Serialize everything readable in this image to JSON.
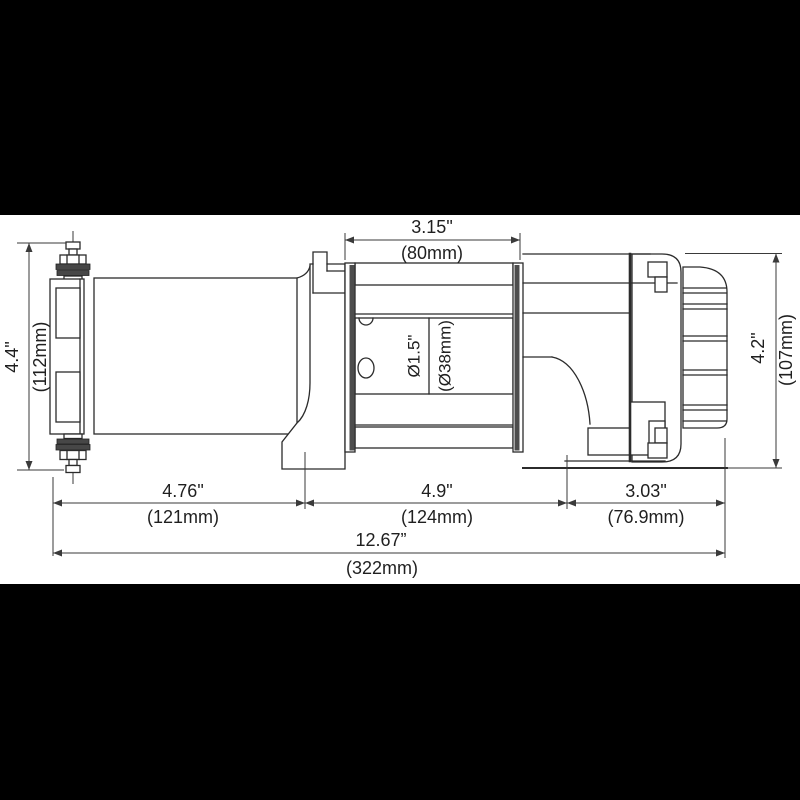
{
  "drawing": {
    "subject": "electric-winch-side-view-dimension-drawing",
    "colors": {
      "background": "#000000",
      "canvas": "#ffffff",
      "line": "#2b2b2b"
    },
    "dimensions": {
      "drum_width_in": "3.15\"",
      "drum_width_mm": "(80mm)",
      "left_height_in": "4.4\"",
      "left_height_mm": "(112mm)",
      "right_height_in": "4.2\"",
      "right_height_mm": "(107mm)",
      "rope_diameter_in": "Ø1.5\"",
      "rope_diameter_mm": "(Ø38mm)",
      "motor_section_in": "4.76\"",
      "motor_section_mm": "(121mm)",
      "drum_section_in": "4.9\"",
      "drum_section_mm": "(124mm)",
      "gear_section_in": "3.03\"",
      "gear_section_mm": "(76.9mm)",
      "overall_width_in": "12.67”",
      "overall_width_mm": "(322mm)"
    }
  }
}
